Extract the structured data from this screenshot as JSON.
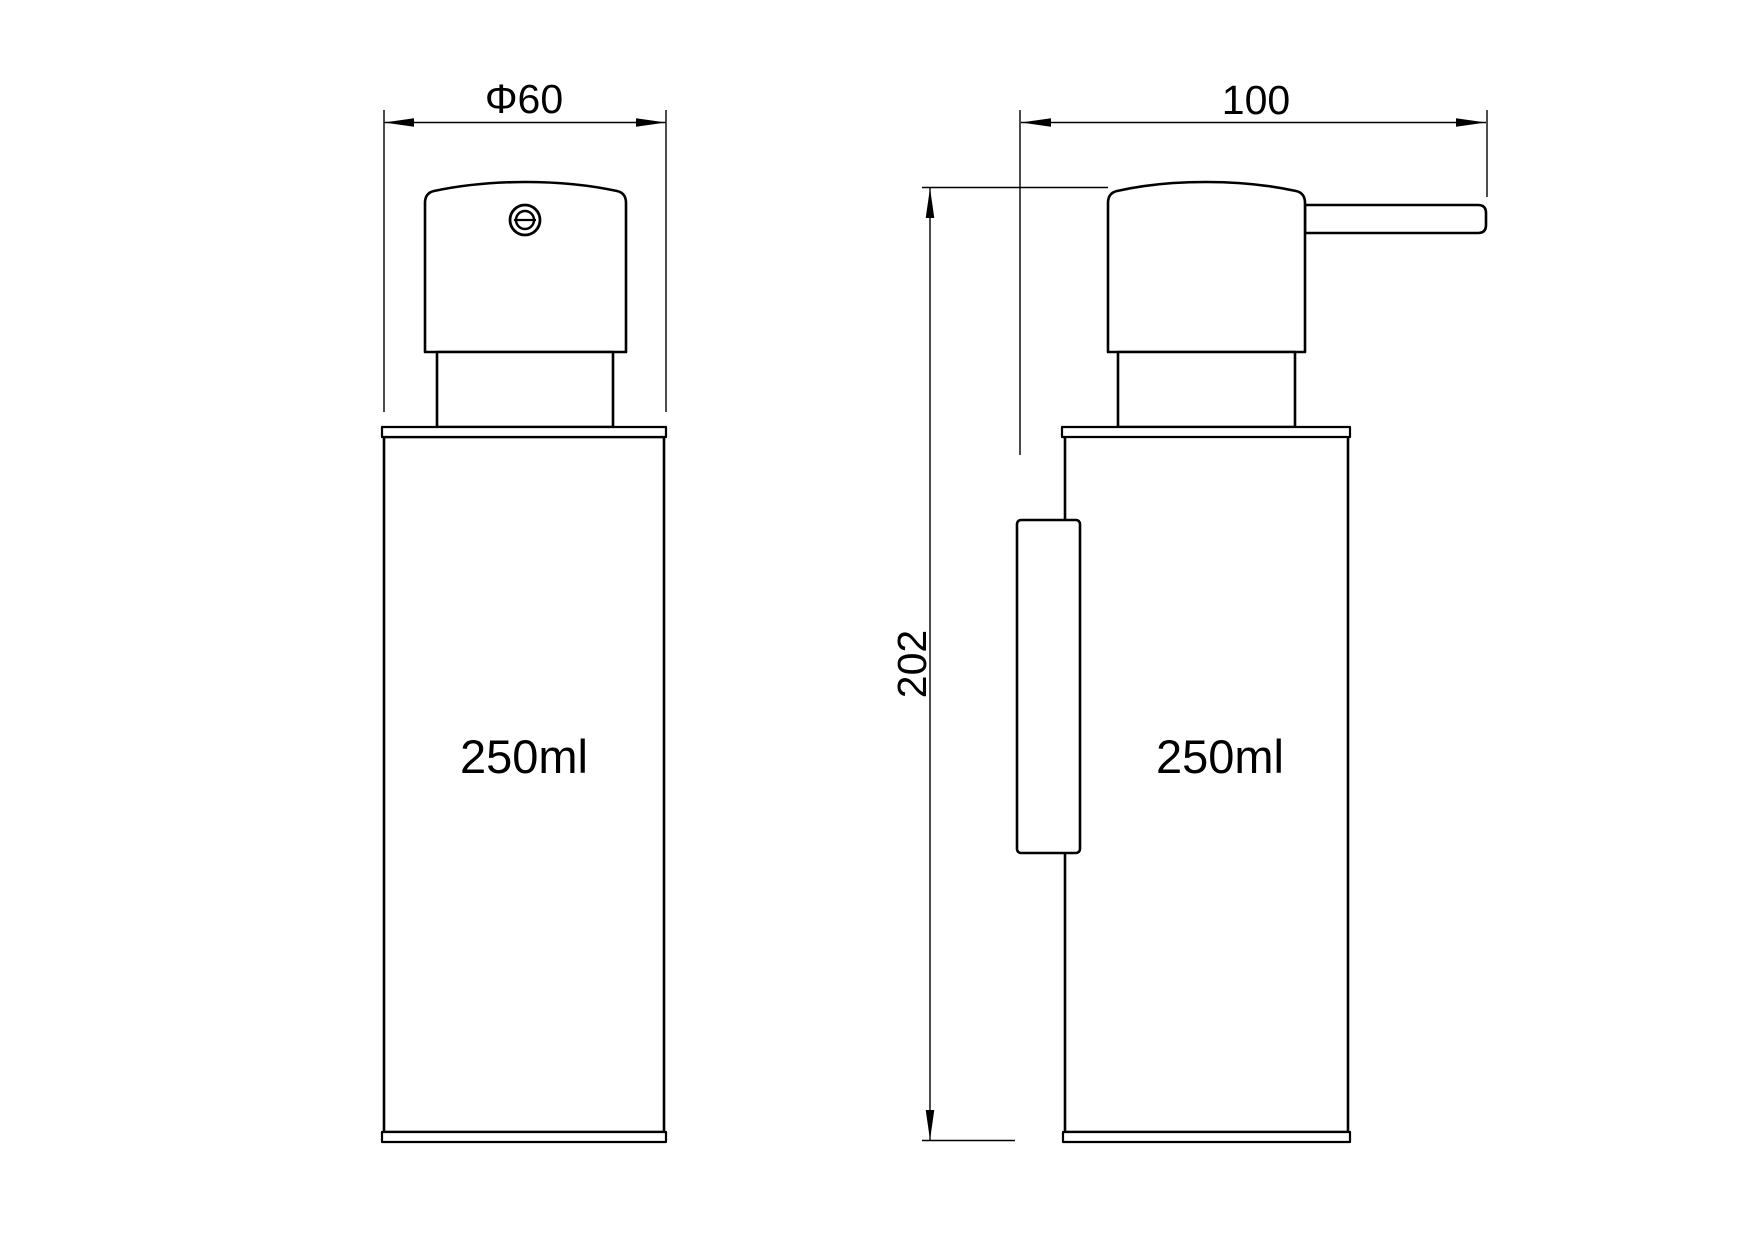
{
  "front_view": {
    "diameter_label": "Φ60",
    "capacity_label": "250ml"
  },
  "side_view": {
    "depth_label": "100",
    "height_label": "202",
    "capacity_label": "250ml"
  },
  "colors": {
    "line_color": "#000000",
    "background": "#ffffff"
  }
}
